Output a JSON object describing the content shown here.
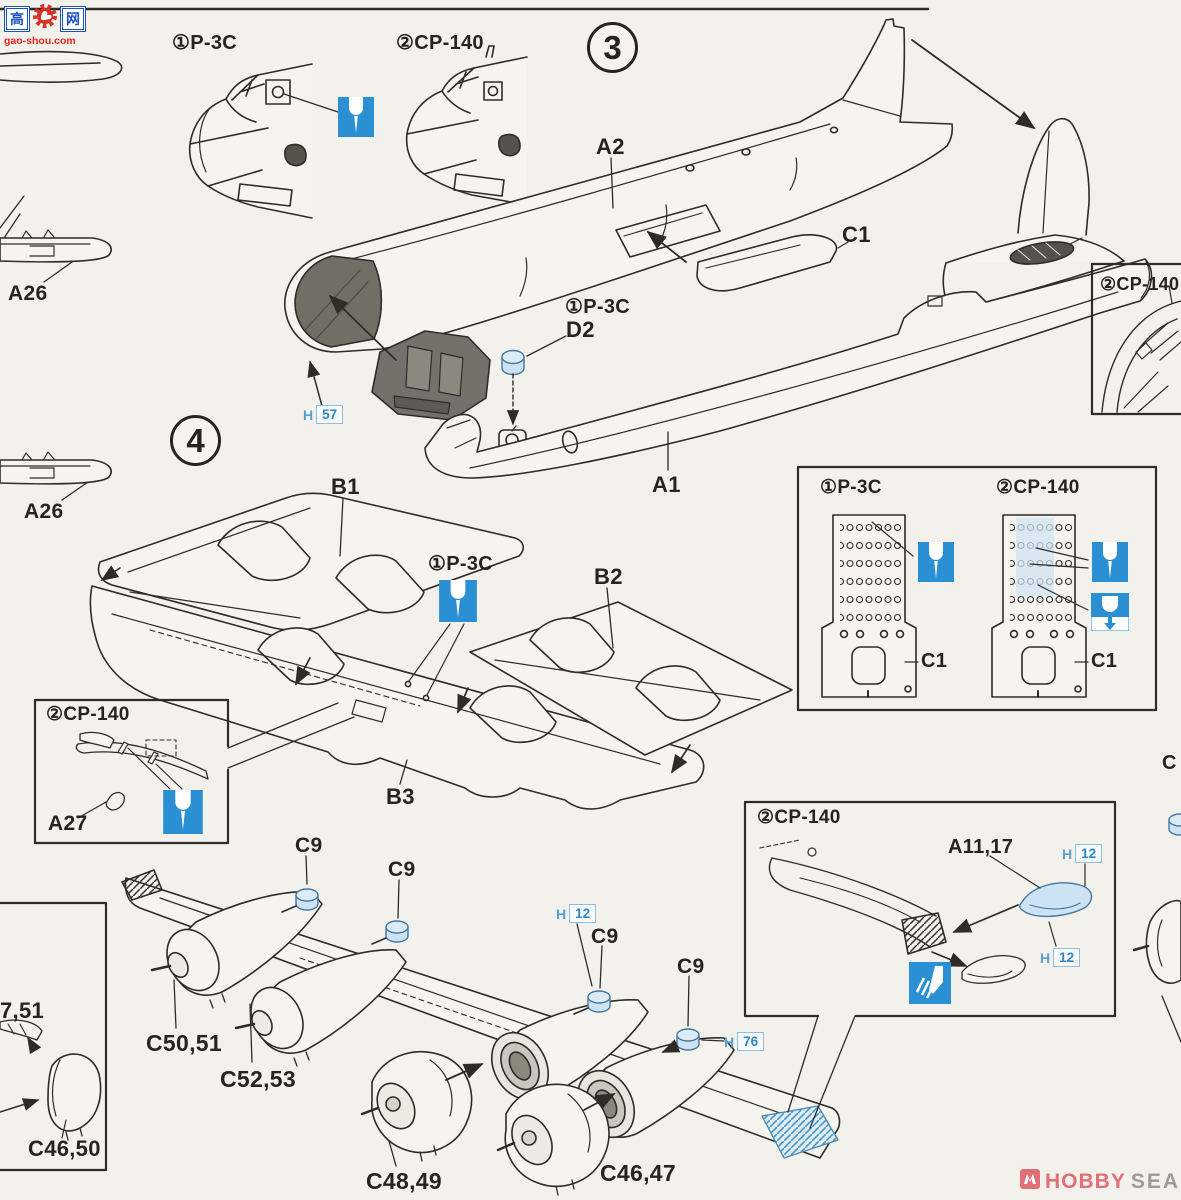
{
  "sheet": {
    "bg": "#f3f1ec"
  },
  "colors": {
    "line": "#2e2c29",
    "accent_blue": "#2b8fd4",
    "part_blue": "#cde3f3",
    "paper": "#f6f4ef"
  },
  "watermarks": {
    "gaoshou": {
      "char_left": "高",
      "char_right": "网",
      "domain": "gao-shou.com"
    },
    "hobbysearch": {
      "word1": "HOBBY",
      "word2": "SEARCH"
    }
  },
  "step3": {
    "number": "3",
    "nose_variant_1": "①P-3C",
    "nose_variant_2": "②CP-140",
    "part_a2": "A2",
    "part_c1": "C1",
    "part_a1": "A1",
    "d2_variant": "①P-3C",
    "part_d2": "D2",
    "paint_h57": {
      "brand": "H",
      "code": "57"
    },
    "cockpit_inset_title": "②CP-140"
  },
  "step4": {
    "number": "4",
    "part_a26_upper": "A26",
    "part_a26_lower": "A26",
    "part_b1": "B1",
    "part_b2": "B2",
    "part_b3": "B3",
    "wing_drill_variant": "①P-3C",
    "a27_inset": {
      "title": "②CP-140",
      "part_a27": "A27"
    },
    "sonobuoy_inset": {
      "variant_1": "①P-3C",
      "variant_2": "②CP-140",
      "part_c1_left": "C1",
      "part_c1_right": "C1"
    },
    "wingtip_inset": {
      "title": "②CP-140",
      "part_a11_17": "A11,17",
      "paint_h12_upper": {
        "brand": "H",
        "code": "12"
      },
      "paint_h12_lower": {
        "brand": "H",
        "code": "12"
      }
    },
    "spinner_labels": [
      "C9",
      "C9",
      "C9",
      "C9"
    ],
    "paint_h12_wing": {
      "brand": "H",
      "code": "12"
    },
    "paint_h76": {
      "brand": "H",
      "code": "76"
    },
    "engine_inner_left": "C50,51",
    "engine_outer_left": "C52,53",
    "cowl_left": "C48,49",
    "cowl_right": "C46,47",
    "cowl_inset": {
      "partial_label": "7,51",
      "part_c46_50": "C46,50"
    },
    "edge_fragment": "C"
  }
}
